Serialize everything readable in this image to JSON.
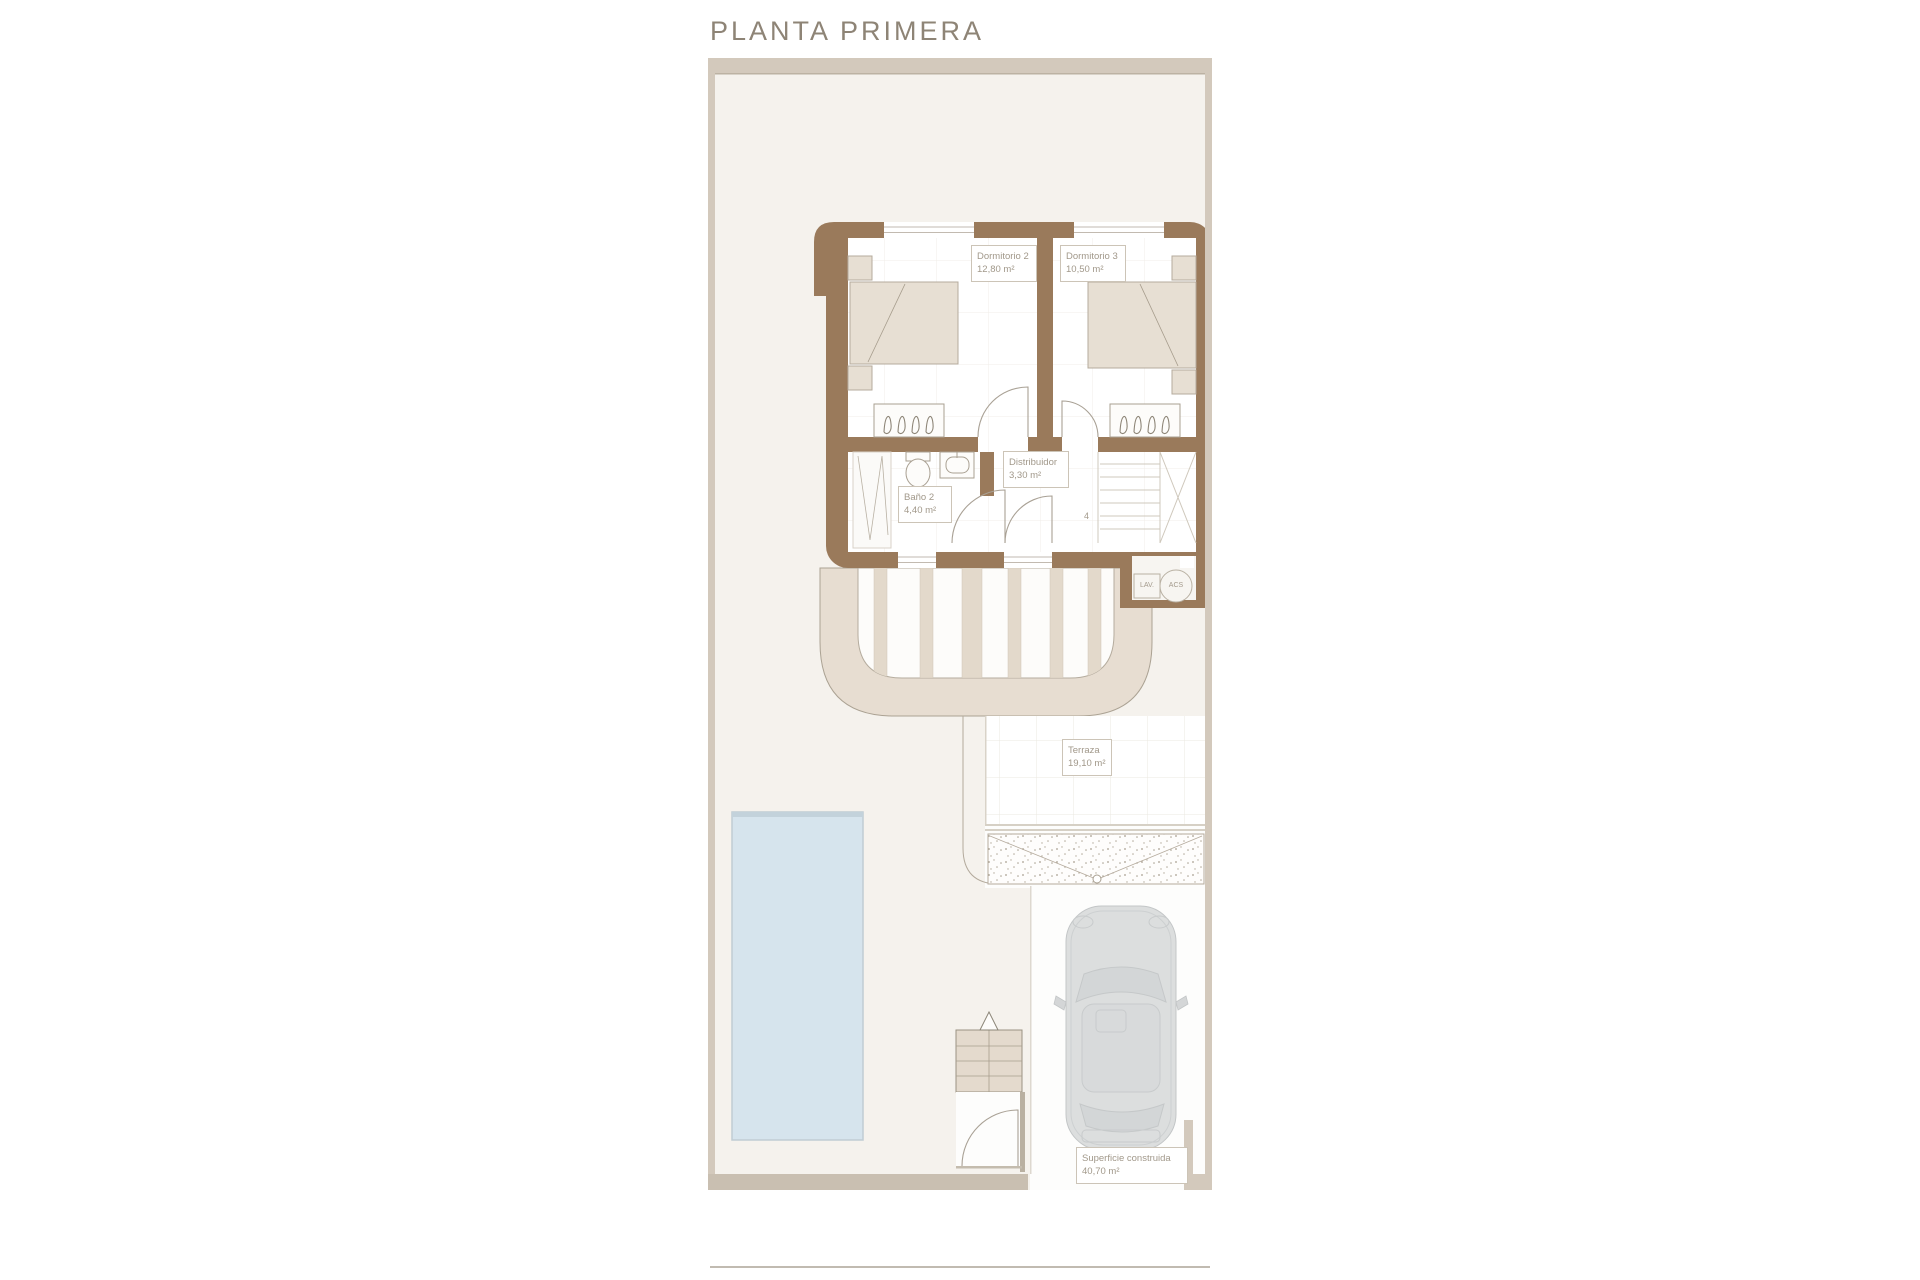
{
  "title": "PLANTA PRIMERA",
  "rooms": {
    "dormitorio2": {
      "name": "Dormitorio 2",
      "area": "12,80 m²"
    },
    "dormitorio3": {
      "name": "Dormitorio 3",
      "area": "10,50 m²"
    },
    "distribuidor": {
      "name": "Distribuidor",
      "area": "3,30 m²"
    },
    "bano2": {
      "name": "Baño 2",
      "area": "4,40 m²"
    },
    "terraza": {
      "name": "Terraza",
      "area": "19,10 m²"
    }
  },
  "summary": {
    "name": "Superficie construida",
    "area": "40,70 m²"
  },
  "utility": {
    "lav": "LAV.",
    "acs": "ACS"
  },
  "stairs": {
    "steps_label": "4"
  },
  "colors": {
    "wall_brown": "#9a7a5b",
    "plot_border": "#d3c9bc",
    "yard_cream": "#f5f2ed",
    "pool_blue": "#d6e4ed",
    "pergola_beige": "#e7ddd1",
    "furniture_beige": "#e7dfd3",
    "car_gray": "#dcdede",
    "label_text": "#a1988a",
    "title_text": "#8e8476"
  }
}
